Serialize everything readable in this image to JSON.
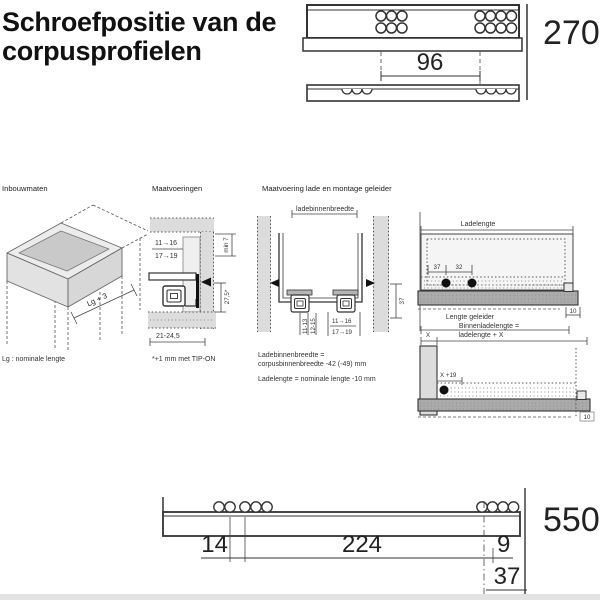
{
  "title": {
    "line1": "Schroefpositie van de",
    "line2": "corpusprofielen"
  },
  "colors": {
    "line": "#333333",
    "panel_gray": "#dcdcdc",
    "rail_gray": "#ababab",
    "text": "#1a1a1a"
  },
  "top_drawing": {
    "hole_spacing": "96",
    "nominal_length": "270"
  },
  "sections": {
    "inbouwmaten": {
      "header": "Inbouwmaten",
      "diagonal_label": "Lg + 3",
      "note": "Lg : nominale lengte"
    },
    "maatvoeringen": {
      "header": "Maatvoeringen",
      "side_thickness_a": "11→16",
      "side_thickness_b": "17→19",
      "min_top_gap": "min 7",
      "profile_height": "27,5*",
      "bottom_range": "21-24,5",
      "footnote": "*+1 mm met TIP-ON"
    },
    "montage": {
      "header": "Maatvoering lade en montage geleider",
      "inner_width_label": "ladebinnenbreedte",
      "bottom_thickness_a": "11-13",
      "bottom_thickness_b": "12-15",
      "side_thickness_a": "11→16",
      "side_thickness_b": "17→19",
      "rail_height": "37",
      "formula_width_1": "Ladebinnenbreedte =",
      "formula_width_2": "corpusbinnenbreedte -42 (-49) mm",
      "formula_length": "Ladelengte = nominale lengte -10 mm"
    },
    "geleider": {
      "drawer_length_label": "Ladelengte",
      "hole_offset_37": "37",
      "hole_pitch_32": "32",
      "rail_overhang": "10",
      "rail_length_label": "Lengte geleider",
      "inner_length_label_1": "Binnenladelengte =",
      "inner_length_label_2": "ladelengte + X",
      "x_label": "X",
      "x_plus_19": "X +19",
      "rail_overhang_2": "10"
    }
  },
  "bottom_drawing": {
    "dim_14": "14",
    "dim_224": "224",
    "dim_9": "9",
    "dim_37": "37",
    "nominal_length": "550"
  }
}
